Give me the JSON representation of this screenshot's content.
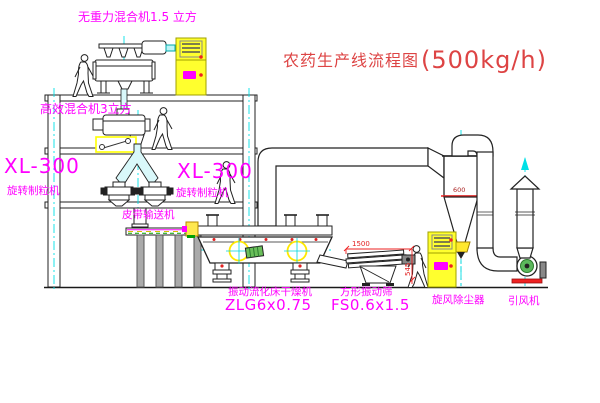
{
  "title": {
    "name": "农药生产线流程图",
    "capacity": "(500kg/h)"
  },
  "labels": {
    "gravity_mixer": "无重力混合机1.5 立方",
    "high_eff_mixer": "高效混合机3立方",
    "granulator_left_model": "XL-300",
    "granulator_left_name": "旋转制粒机",
    "granulator_right_model": "XL-300",
    "granulator_right_name": "旋转制粒机",
    "belt_conveyor": "皮带输送机",
    "dryer_name": "振动流化床干燥机",
    "dryer_model": "ZLG6x0.75",
    "sieve_name": "方形振动筛",
    "sieve_model": "FS0.6x1.5",
    "cyclone": "旋风除尘器",
    "fan": "引风机"
  },
  "dims": {
    "cyclone_diameter": "600",
    "sieve_length": "1500",
    "sieve_height": "545"
  },
  "colors": {
    "label": "#ff00ff",
    "title": "#dd4444",
    "centerline": "#00e0e6",
    "highlight": "#ffff00",
    "dimension": "#ee2222",
    "machine_green": "#5cb85c",
    "cabinet_yellow": "#ffff2e"
  }
}
